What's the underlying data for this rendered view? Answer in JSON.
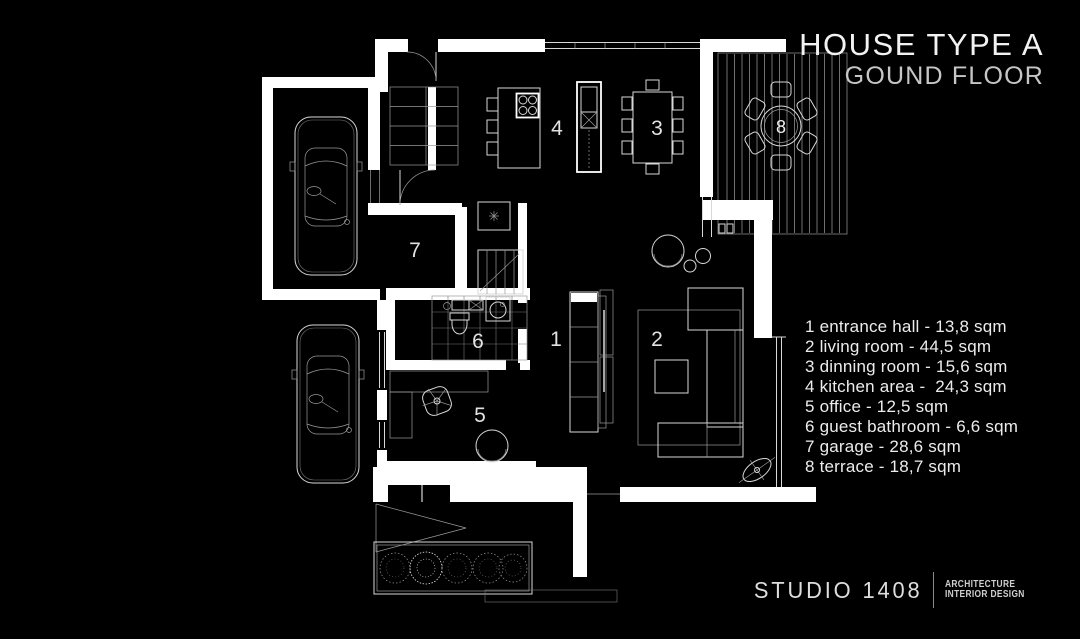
{
  "header": {
    "title": "HOUSE TYPE A",
    "subtitle": "GOUND FLOOR"
  },
  "legend": {
    "items": [
      "1 entrance hall - 13,8 sqm",
      "2 living room - 44,5 sqm",
      "3 dinning room - 15,6 sqm",
      "4 kitchen area -  24,3 sqm",
      "5 office - 12,5 sqm",
      "6 guest bathroom - 6,6 sqm",
      "7 garage - 28,6 sqm",
      "8 terrace - 18,7 sqm"
    ]
  },
  "plan": {
    "room_numbers": {
      "entrance_hall": "1",
      "living_room": "2",
      "dinning_room": "3",
      "kitchen_area": "4",
      "office": "5",
      "guest_bathroom": "6",
      "garage": "7",
      "terrace": "8"
    }
  },
  "footer": {
    "studio_name": "STUDIO 1408",
    "tagline_line1": "ARCHITECTURE",
    "tagline_line2": "INTERIOR DESIGN"
  },
  "colors": {
    "background": "#000000",
    "line_primary": "#ffffff",
    "text_primary": "#f2f2f2",
    "text_secondary": "#c6c6c6"
  }
}
